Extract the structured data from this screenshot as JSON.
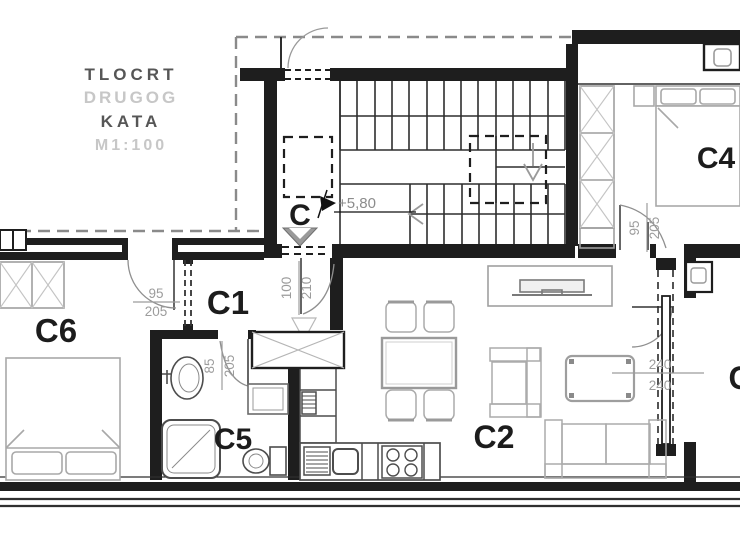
{
  "plan": {
    "title": {
      "l1": "TLOCRT",
      "l2": "DRUGOG",
      "l3": "KATA",
      "l4": "M1:100"
    },
    "rooms": {
      "stair_hall": "C",
      "entry_hall": "C1",
      "living_kitchen": "C2",
      "bedroom_right": "C4",
      "bathroom": "C5",
      "bedroom_left": "C6",
      "neighbor_partial": "C"
    },
    "levels": {
      "stair_level": "+5,80"
    },
    "doors": {
      "c6_width": "95",
      "c6_height": "205",
      "entry_width": "100",
      "entry_height": "210",
      "bath_width": "85",
      "bath_height": "205",
      "c4_width": "95",
      "c4_height": "205",
      "slide_width": "240",
      "slide_height": "240"
    },
    "colors": {
      "wall": "#1e1e1e",
      "stair_line": "#2e2e2e",
      "furniture": "#a8a8a8",
      "fixture": "#4d4d4d",
      "dimension_text": "#9c9c9c",
      "label_text": "#1c1c1c",
      "title_dark": "#565656",
      "title_light": "#c7c7c7",
      "background": "#ffffff"
    }
  }
}
